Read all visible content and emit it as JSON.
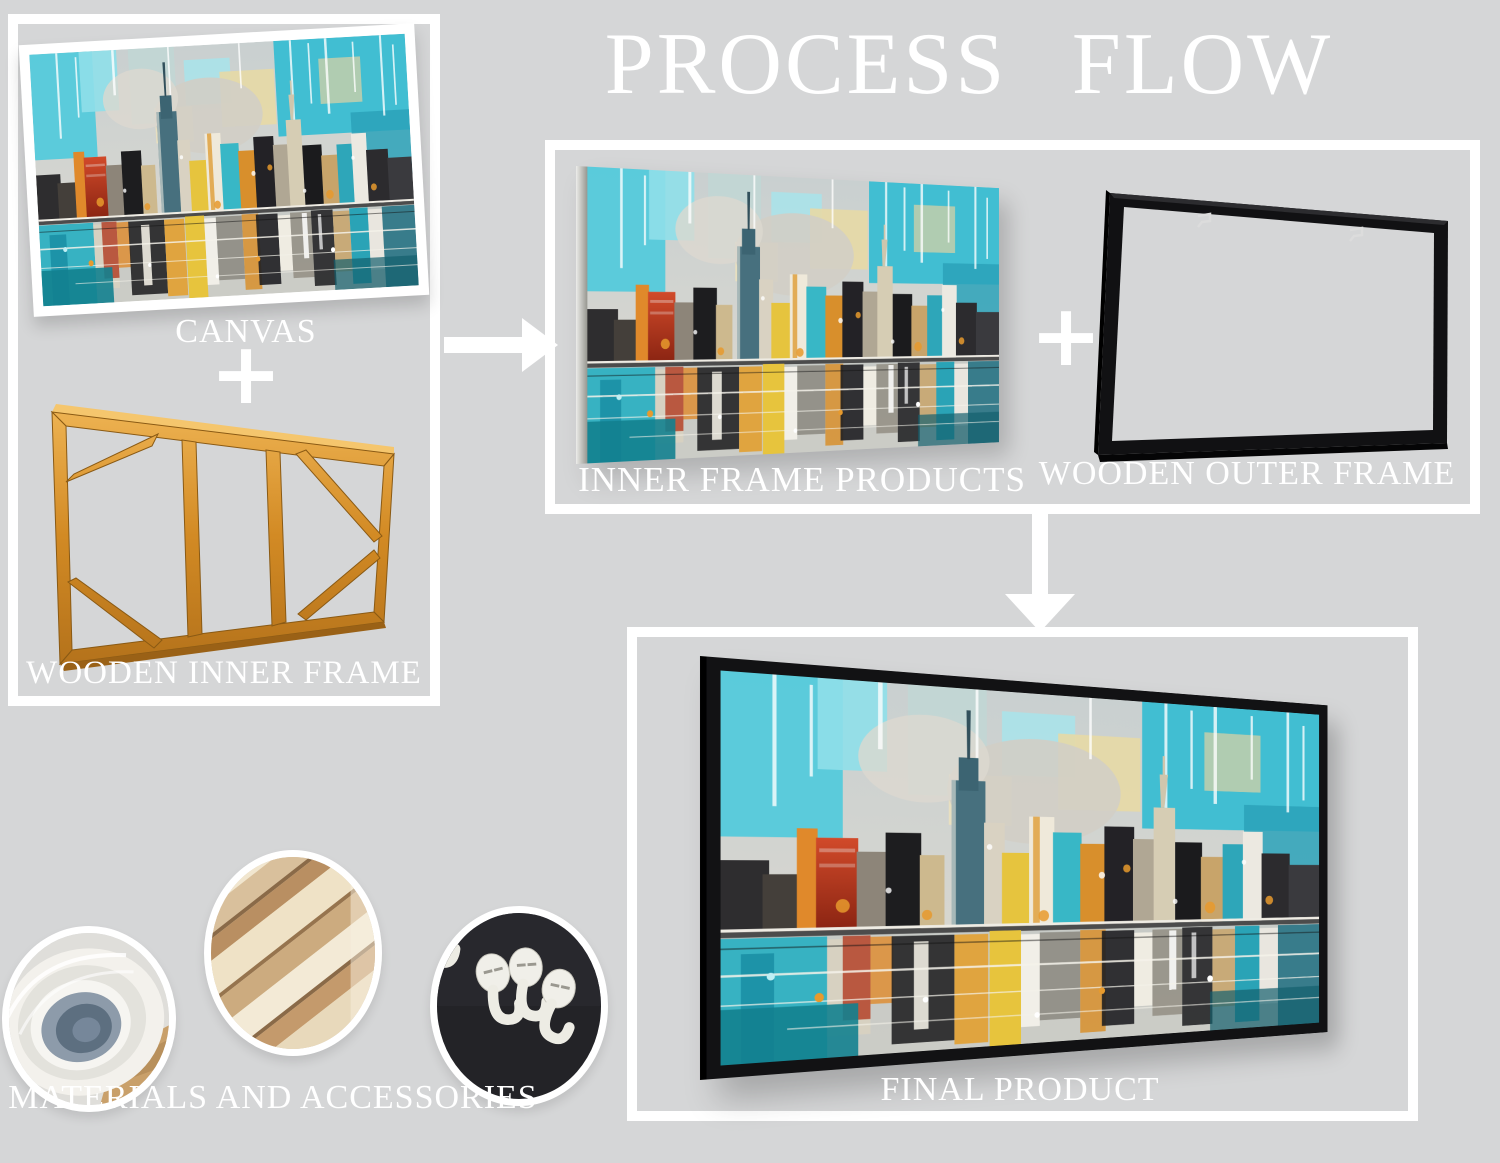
{
  "title": "PROCESS FLOW",
  "operators": {
    "plus": "+"
  },
  "panels": {
    "components": {
      "canvas_label": "CANVAS",
      "inner_frame_label": "WOODEN INNER FRAME"
    },
    "assembly": {
      "inner_products_label": "INNER FRAME PRODUCTS",
      "outer_frame_label": "WOODEN OUTER FRAME"
    },
    "final": {
      "label": "FINAL PRODUCT"
    },
    "materials": {
      "label": "MATERIALS AND ACCESSORIES"
    }
  },
  "icons": {
    "arrow_right": "right-arrow-connector",
    "arrow_down": "down-arrow-connector",
    "plus": "plus-operator"
  },
  "colors": {
    "background": "#d5d6d7",
    "panel_border": "#ffffff",
    "text": "#ffffff",
    "inner_frame_wood": "#d28a24",
    "outer_frame_black": "#121214",
    "art_teal": "#3fbdd1",
    "art_orange": "#e2952f",
    "art_red": "#c23a22",
    "art_yellow": "#e7c43d"
  }
}
